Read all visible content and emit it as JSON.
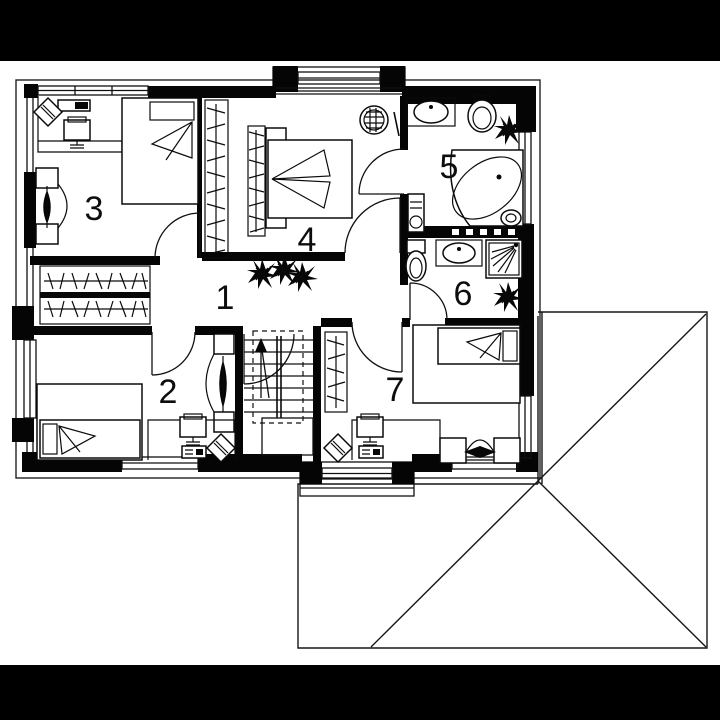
{
  "colors": {
    "ink": "#000000",
    "paper": "#ffffff",
    "letterbox": "#000000"
  },
  "rooms": [
    {
      "number": "1"
    },
    {
      "number": "2"
    },
    {
      "number": "3"
    },
    {
      "number": "4"
    },
    {
      "number": "5"
    },
    {
      "number": "6"
    },
    {
      "number": "7"
    }
  ],
  "icons": {
    "plant-icon": "spiky-star-shape",
    "single-bed-icon": "rect-with-pillow-and-blanket-fan",
    "double-bed-icon": "rect-with-headboard-and-blanket-fan",
    "desk-icon": "open-rectangle",
    "office-chair-icon": "rotated-diamond",
    "monitor-icon": "rect-with-stand",
    "printer-icon": "small-rect-with-buttons",
    "wardrobe-rail-icon": "rail-with-hanger-hatching",
    "radiator-icon": "wall-brackets-with-leaf-arrow",
    "stairs-icon": "treads-with-walkline-arrow",
    "bathtub-icon": "corner-tub-with-oval",
    "sink-icon": "counter-with-oval-basin",
    "toilet-icon": "cistern-with-bowl",
    "shower-icon": "square-with-spray-lines",
    "towel-warmer-icon": "small-rect-with-knob",
    "laundry-basket-icon": "woven-circle",
    "sofa-icon": "bench-with-side-tables",
    "door-icon": "leaf-with-quarter-arc",
    "window-icon": "triple-parallel-lines",
    "roof-icon": "hip-roof-ridge-lines"
  }
}
